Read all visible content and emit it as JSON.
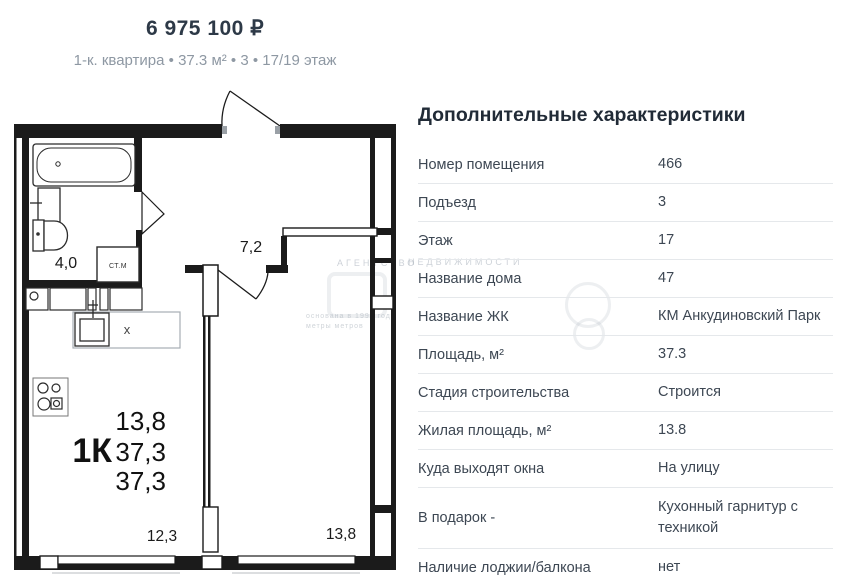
{
  "header": {
    "price": "6 975 100 ₽",
    "subtitle": "1-к. квартира • 37.3 м² • 3 • 17/19 этаж"
  },
  "panel": {
    "title": "Дополнительные характеристики",
    "rows": [
      {
        "label": "Номер помещения",
        "value": "466"
      },
      {
        "label": "Подъезд",
        "value": "3"
      },
      {
        "label": "Этаж",
        "value": "17"
      },
      {
        "label": "Название дома",
        "value": "47"
      },
      {
        "label": "Название ЖК",
        "value": "КМ Анкудиновский Парк"
      },
      {
        "label": "Площадь, м²",
        "value": "37.3"
      },
      {
        "label": "Стадия строительства",
        "value": "Строится"
      },
      {
        "label": "Жилая площадь, м²",
        "value": "13.8"
      },
      {
        "label": "Куда выходят окна",
        "value": "На улицу"
      },
      {
        "label": "В подарок -",
        "value": "Кухонный гарнитур с техникой"
      },
      {
        "label": "Наличие лоджии/балкона",
        "value": "нет"
      }
    ]
  },
  "plan": {
    "type_label": "1К",
    "living_area": "13,8",
    "total_area": "37,3",
    "reduced_area": "37,3",
    "hall_area": "7,2",
    "bathroom_area": "4,0",
    "kitchen_living_area": "12,3",
    "room_area": "13,8",
    "washing_machine_label": "СТ.М",
    "sink_mark": "x"
  },
  "watermark": {
    "word1": "АГЕНТСТВО",
    "word2": "НЕДВИЖИМОСТИ",
    "line1": "основана в 1999 году",
    "line2": "метры метров"
  },
  "colors": {
    "wall": "#1b1b1b",
    "text_dark": "#2d3947",
    "text_gray": "#8e98a3",
    "divider": "#e5e8eb"
  }
}
